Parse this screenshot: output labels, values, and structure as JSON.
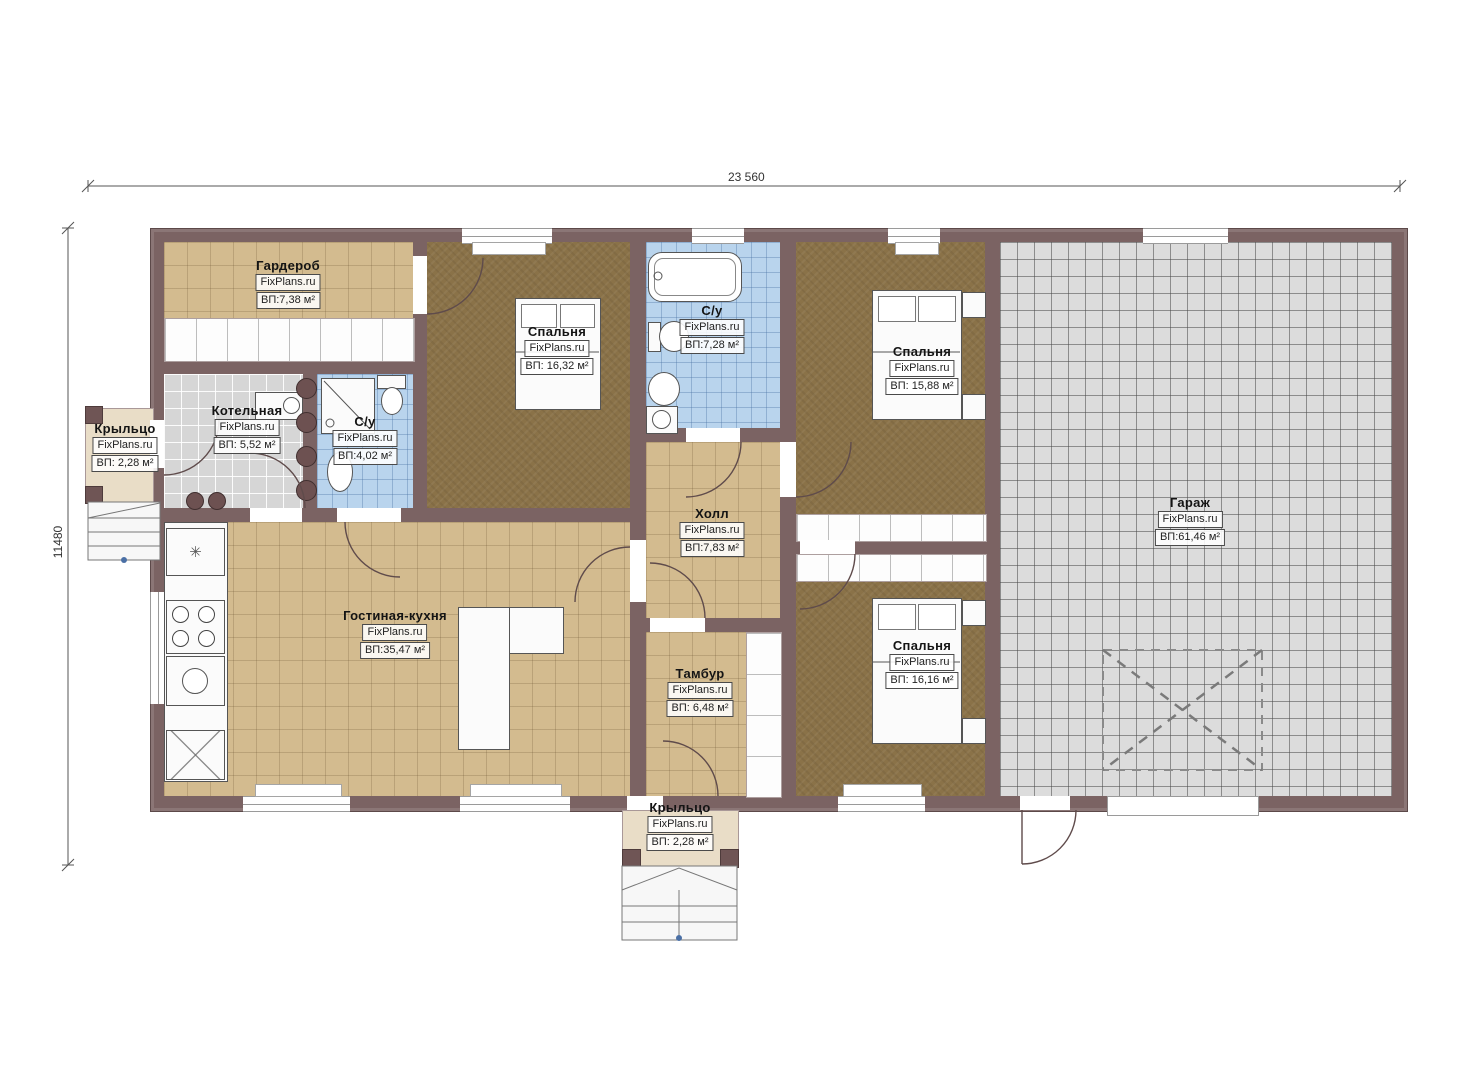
{
  "plan": {
    "watermark": "FixPlans.ru",
    "dimensions": {
      "width_label": "23 560",
      "height_label": "11480"
    },
    "rooms": [
      {
        "id": "garderob",
        "name": "Гардероб",
        "watermark": "FixPlans.ru",
        "area": "ВП:7,38 м²"
      },
      {
        "id": "bedroom-1",
        "name": "Спальня",
        "watermark": "FixPlans.ru",
        "area": "ВП: 16,32 м²"
      },
      {
        "id": "bathroom-top",
        "name": "С/у",
        "watermark": "FixPlans.ru",
        "area": "ВП:7,28 м²"
      },
      {
        "id": "bedroom-2",
        "name": "Спальня",
        "watermark": "FixPlans.ru",
        "area": "ВП: 15,88 м²"
      },
      {
        "id": "garage",
        "name": "Гараж",
        "watermark": "FixPlans.ru",
        "area": "ВП:61,46 м²"
      },
      {
        "id": "boiler",
        "name": "Котельная",
        "watermark": "FixPlans.ru",
        "area": "ВП: 5,52 м²"
      },
      {
        "id": "bathroom-small",
        "name": "С/у",
        "watermark": "FixPlans.ru",
        "area": "ВП:4,02 м²"
      },
      {
        "id": "porch-left",
        "name": "Крыльцо",
        "watermark": "FixPlans.ru",
        "area": "ВП: 2,28 м²"
      },
      {
        "id": "hall",
        "name": "Холл",
        "watermark": "FixPlans.ru",
        "area": "ВП:7,83 м²"
      },
      {
        "id": "living-kitchen",
        "name": "Гостиная-кухня",
        "watermark": "FixPlans.ru",
        "area": "ВП:35,47 м²"
      },
      {
        "id": "tambur",
        "name": "Тамбур",
        "watermark": "FixPlans.ru",
        "area": "ВП: 6,48 м²"
      },
      {
        "id": "bedroom-3",
        "name": "Спальня",
        "watermark": "FixPlans.ru",
        "area": "ВП: 16,16 м²"
      },
      {
        "id": "porch-bottom",
        "name": "Крыльцо",
        "watermark": "FixPlans.ru",
        "area": "ВП: 2,28 м²"
      }
    ],
    "colors": {
      "wall": "#7b6363",
      "floor_tan": "#d3bb8f",
      "floor_brown": "#8a7248",
      "floor_blue": "#b9d4ed",
      "floor_gray": "#d6d6d6",
      "floor_garage": "#dcdcdc",
      "porch": "#e9ddc7"
    }
  }
}
